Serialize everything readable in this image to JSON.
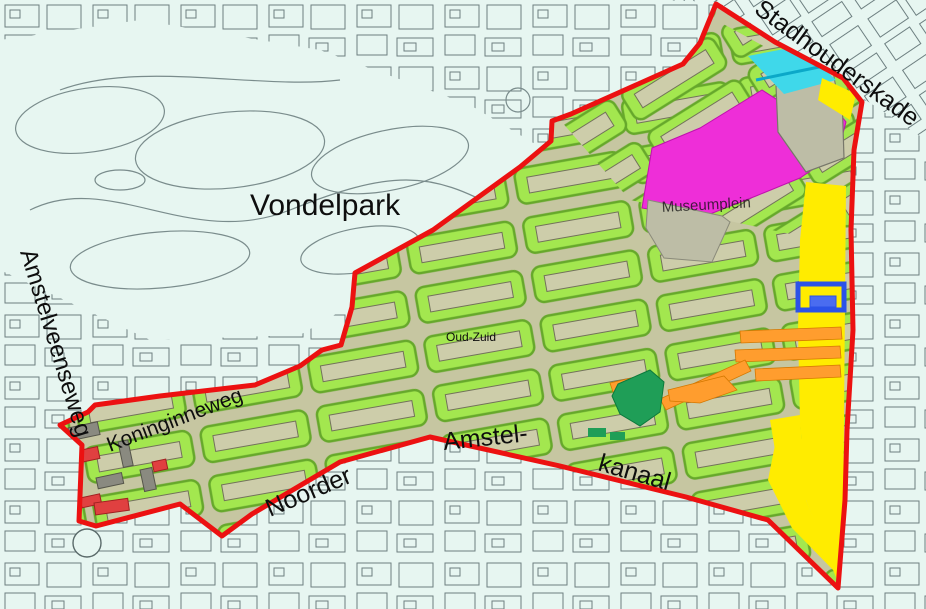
{
  "map": {
    "labels": {
      "vondelpark": {
        "text": "Vondelpark"
      },
      "amstelveenseweg": {
        "text": "Amstelveenseweg"
      },
      "stadhouderskade": {
        "text": "Stadhouderskade"
      },
      "koninginneweg": {
        "text": "Koninginneweg"
      },
      "noorder": {
        "text": "Noorder"
      },
      "amstel": {
        "text": "Amstel-"
      },
      "kanaal": {
        "text": "kanaal"
      },
      "oud_zuid": {
        "text": "Oud-Zuid"
      },
      "museumplein": {
        "text": "Museumplein"
      }
    },
    "palette": {
      "background": "#e7f6f1",
      "line_gray": "#6d7f80",
      "district_base": "#c6c6a1",
      "block_green": "#a3e74f",
      "block_green_edge": "#66a82b",
      "building_tan": "#cdcdaa",
      "boundary_red": "#ec1111",
      "zone_yellow": "#ffec00",
      "zone_orange": "#ff9d2e",
      "zone_magenta": "#ee2ed8",
      "zone_cyan": "#3fd8ea",
      "zone_teal_line": "#0ba8c8",
      "zone_blue": "#2b52e8",
      "zone_blue_fill": "#4a6cf0",
      "zone_dark_green": "#1f9e57",
      "open_space_gray": "#bdbda6",
      "building_gray": "#8a8a80",
      "building_red": "#e04040"
    }
  }
}
